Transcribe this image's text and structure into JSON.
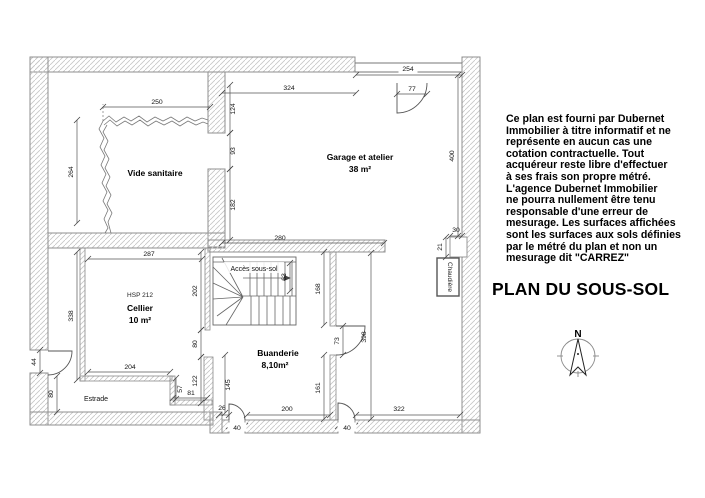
{
  "title": "PLAN DU SOUS-SOL",
  "disclaimer": {
    "lines": [
      "Ce plan est fourni par Dubernet",
      "Immobilier à titre informatif et ne",
      "représente en aucun cas une",
      "cotation contractuelle. Tout",
      "acquéreur reste libre d'effectuer",
      "à ses frais son propre métré.",
      "L'agence  Dubernet Immobilier",
      "ne pourra nullement être tenu",
      "responsable d'une erreur de",
      "mesurage. Les surfaces affichées",
      "sont les surfaces aux sols définies",
      "par le métré du plan et non un",
      "mesurage dit \"CARREZ\""
    ]
  },
  "rooms": {
    "vide_sanitaire": {
      "name": "Vide sanitaire"
    },
    "garage": {
      "name": "Garage et atelier",
      "area": "38 m²"
    },
    "cellier": {
      "hsp": "HSP 212",
      "name": "Cellier",
      "area": "10 m²"
    },
    "buanderie": {
      "name": "Buanderie",
      "area": "8,10m²"
    },
    "stairs": {
      "name": "Accès sous-sol"
    },
    "estrade": {
      "name": "Estrade"
    },
    "chaudiere": {
      "name": "Chaudière"
    }
  },
  "compass": {
    "north_label": "N"
  },
  "dimensions_cm": {
    "vide_top": "250",
    "vide_left": "264",
    "garage_top_left": "324",
    "garage_top_opening": "254",
    "garage_top_door": "77",
    "garage_wall_upper": "124",
    "garage_wall_opening": "93",
    "garage_wall_lower": "182",
    "garage_right": "400",
    "garage_bottom": "280",
    "right_notch_width": "30",
    "right_notch_height": "21",
    "cellier_top": "287",
    "cellier_left": "338",
    "cellier_right_upper": "202",
    "cellier_door": "80",
    "cellier_right_lower": "122",
    "cellier_bottom": "204",
    "cellier_step": "57",
    "cellier_bottom_right": "81",
    "estrade_door": "44",
    "estrade_left": "80",
    "stairs_width": "63",
    "buanderie_right_upper": "168",
    "buanderie_door": "73",
    "buanderie_right_lower": "161",
    "buanderie_left": "145",
    "buanderie_offset": "26",
    "buanderie_bottom": "200",
    "door_bottom_left": "40",
    "door_bottom_right": "40",
    "area_right_height": "398",
    "area_right_bottom": "322"
  }
}
